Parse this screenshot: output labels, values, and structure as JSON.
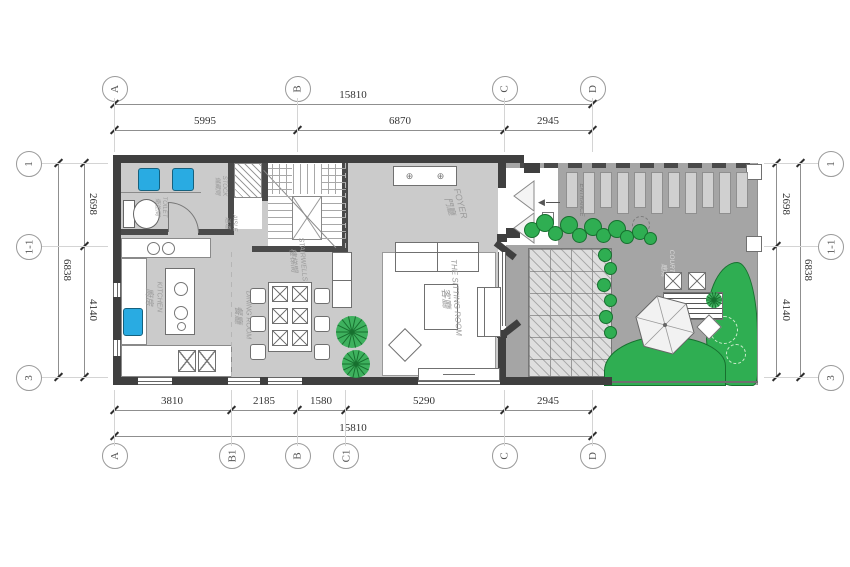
{
  "colors": {
    "wall": "#3f3f3f",
    "interior_wall": "#4a4a4a",
    "floor": "#cbcbcb",
    "garden": "#a5a5a5",
    "deck": "#dedede",
    "stepping_stone": "#d0d0d0",
    "plant_green": "#2fae52",
    "plant_dark": "#17702f",
    "fixture_blue": "#29abe2",
    "dim_line": "#8f8f8f",
    "dim_text": "#333333",
    "room_label": "#9b9b9b"
  },
  "dimensions": {
    "top": {
      "total": "15810",
      "segments": [
        "5995",
        "6870",
        "2945"
      ]
    },
    "bottom": {
      "total": "15810",
      "segments": [
        "3810",
        "2185",
        "1580",
        "5290",
        "2945"
      ]
    },
    "left": {
      "total": "6838",
      "segments": [
        "2698",
        "4140"
      ]
    },
    "right": {
      "total": "6838",
      "segments": [
        "2698",
        "4140"
      ]
    }
  },
  "grid_bubbles": {
    "top": [
      "A",
      "B",
      "C",
      "D"
    ],
    "bottom": [
      "A",
      "B1",
      "B",
      "C1",
      "C",
      "D"
    ],
    "left": [
      "1",
      "1-1",
      "3"
    ],
    "right": [
      "1",
      "1-1",
      "3"
    ]
  },
  "rooms": {
    "foyer": {
      "en": "FOYER",
      "zh": "門廳"
    },
    "sitting": {
      "en": "THE SITTING ROOM",
      "zh": "客廳"
    },
    "dining": {
      "en": "DINING ROOM",
      "zh": "餐廳"
    },
    "kitchen": {
      "en": "KITCHEN",
      "zh": "廚房"
    },
    "stairwell": {
      "en": "STAIRWELLS",
      "zh": "樓梯間"
    },
    "toilet": {
      "en": "TOILET",
      "zh": "衛生間"
    },
    "stock": {
      "en": "STOCK",
      "zh": "儲藏間"
    },
    "aisle": {
      "en": "AISLE",
      "zh": "過道"
    },
    "entrance": {
      "en": "ENTRANCE",
      "zh": "入口"
    },
    "courtyard": {
      "en": "COURTYARD",
      "zh": "庭院"
    }
  },
  "icons": {
    "cabinet_handle": "⊕",
    "entry_arrow": "◀"
  }
}
